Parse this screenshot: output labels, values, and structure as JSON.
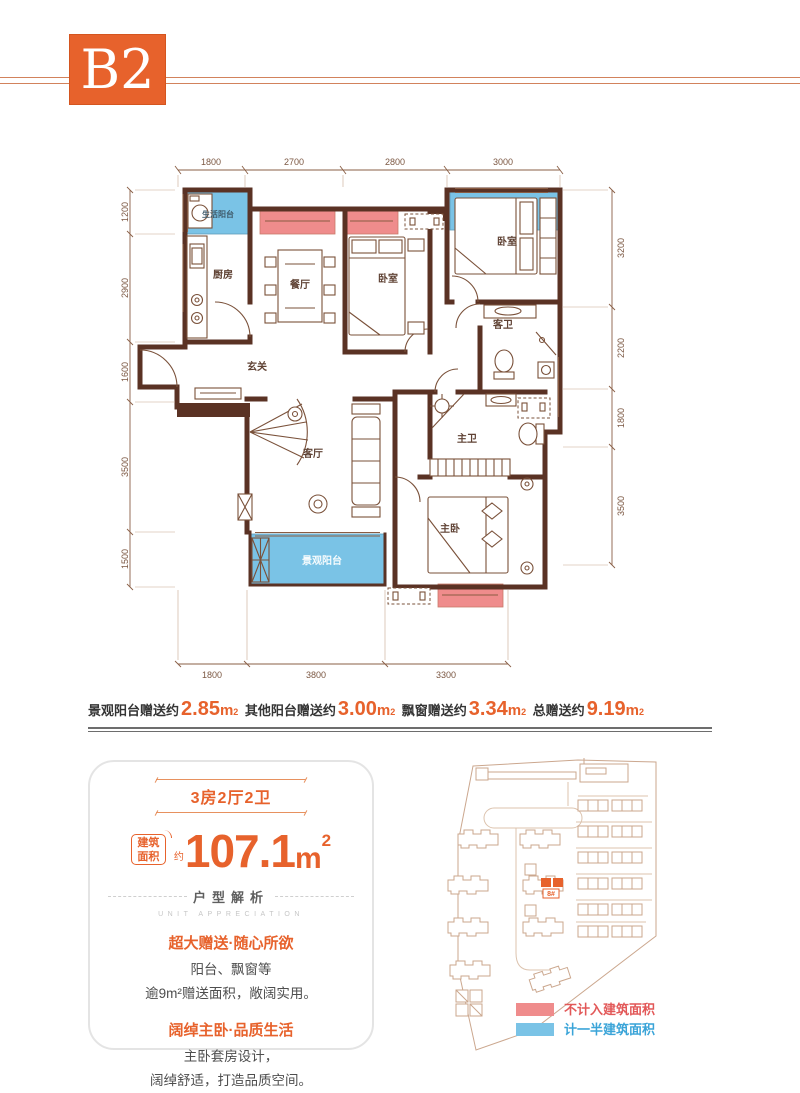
{
  "header": {
    "badge": "B2"
  },
  "plan": {
    "dims": {
      "top": [
        "1800",
        "2700",
        "2800",
        "3000"
      ],
      "left": [
        "1200",
        "2900",
        "1600",
        "3500",
        "1500"
      ],
      "right": [
        "3200",
        "2200",
        "1800",
        "3500"
      ],
      "bottom": [
        "1800",
        "3800",
        "3300"
      ]
    },
    "rooms": {
      "life_balcony": "生活阳台",
      "kitchen": "厨房",
      "dining": "餐厅",
      "bedroom_mid": "卧室",
      "bedroom_top": "卧室",
      "guest_bath": "客卫",
      "foyer": "玄关",
      "living": "客厅",
      "master_bath": "主卫",
      "master_bed": "主卧",
      "view_balcony": "景观阳台"
    }
  },
  "gifts": {
    "sup": "2",
    "items": [
      {
        "label": "景观阳台赠送约",
        "value": "2.85",
        "unit": "m"
      },
      {
        "label": "其他阳台赠送约",
        "value": "3.00",
        "unit": "m"
      },
      {
        "label": "飘窗赠送约",
        "value": "3.34",
        "unit": "m"
      },
      {
        "label": "总赠送约",
        "value": "9.19",
        "unit": "m"
      }
    ]
  },
  "card": {
    "unit_type": "3房2厅2卫",
    "area_label_l1": "建筑",
    "area_label_l2": "面积",
    "area_about": "约",
    "area_value": "107.1",
    "area_unit": "m",
    "area_sup": "2",
    "section_title": "户型解析",
    "section_subtitle": "UNIT APPRECIATION",
    "features": [
      {
        "title": "超大赠送·随心所欲",
        "line1": "阳台、飘窗等",
        "line2": "逾9m²赠送面积，敞阔实用。"
      },
      {
        "title": "阔绰主卧·品质生活",
        "line1": "主卧套房设计，",
        "line2": "阔绰舒适，打造品质空间。"
      }
    ]
  },
  "siteplan": {
    "building_label": "8#",
    "legend": [
      {
        "label": "不计入建筑面积",
        "swatch": "#ef8c8c"
      },
      {
        "label": "计一半建筑面积",
        "swatch": "#7ac3e6"
      }
    ]
  },
  "colors": {
    "accent": "#e7622c",
    "wall": "#5a3224",
    "half_area_blue": "#7ac3e6",
    "excluded_red": "#ef8c8c",
    "legend_red_text": "#e25858",
    "legend_blue_text": "#3aa4d8"
  }
}
